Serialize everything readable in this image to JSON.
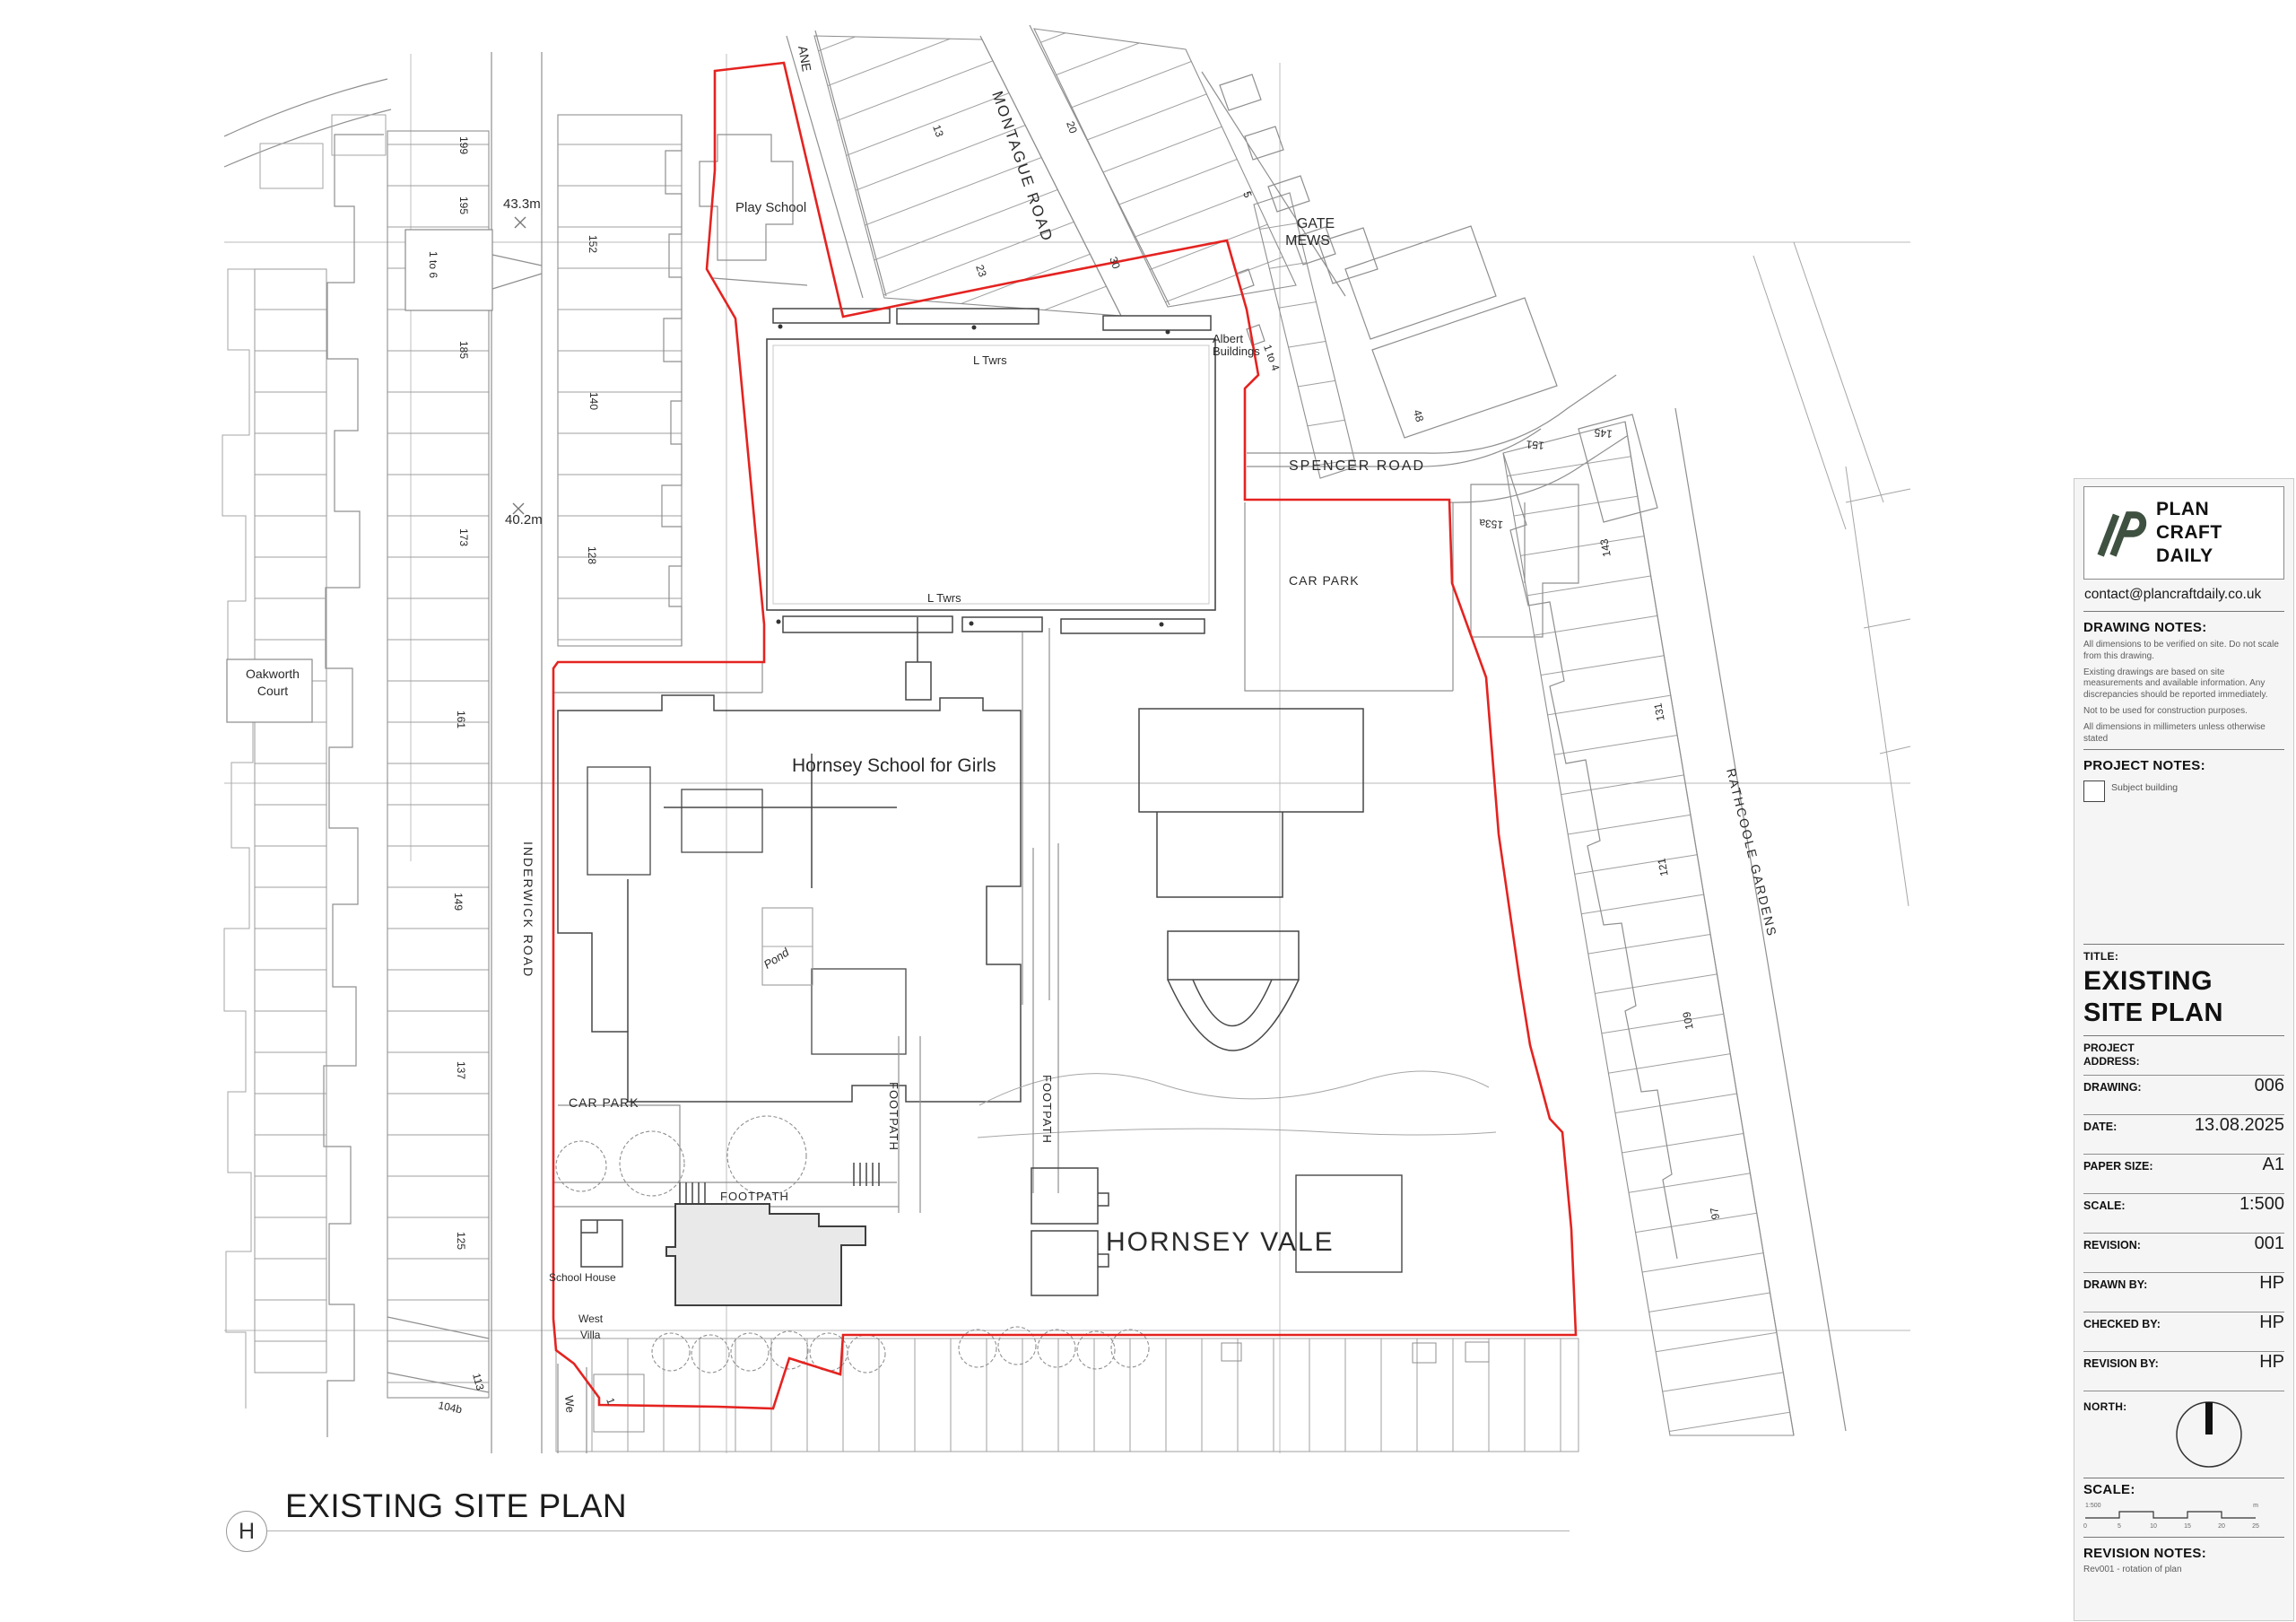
{
  "colors": {
    "boundary_red": "#e42320",
    "line_grey": "#8f8f8f",
    "site_line": "#474747",
    "subject_fill": "#e9e9e9",
    "panel_bg": "#f5f5f5",
    "logo_green": "#3f5140"
  },
  "sheet": {
    "plan_label": "EXISTING SITE PLAN",
    "detail_marker": "H"
  },
  "map": {
    "labels": [
      {
        "id": "play-school",
        "text": "Play School"
      },
      {
        "id": "lane-partial",
        "text": "ANE"
      },
      {
        "id": "montague-road",
        "text": "MONTAGUE ROAD"
      },
      {
        "id": "gate-mews-1",
        "text": "GATE"
      },
      {
        "id": "gate-mews-2",
        "text": "MEWS"
      },
      {
        "id": "albert-1",
        "text": "Albert"
      },
      {
        "id": "albert-2",
        "text": "Buildings"
      },
      {
        "id": "no-1to4",
        "text": "1 to 4"
      },
      {
        "id": "no-5",
        "text": "5"
      },
      {
        "id": "no-13",
        "text": "13"
      },
      {
        "id": "no-23",
        "text": "23"
      },
      {
        "id": "no-20",
        "text": "20"
      },
      {
        "id": "no-30",
        "text": "30"
      },
      {
        "id": "no-48",
        "text": "48"
      },
      {
        "id": "spencer-road",
        "text": "SPENCER ROAD"
      },
      {
        "id": "car-park-east",
        "text": "CAR PARK"
      },
      {
        "id": "l-twrs-1",
        "text": "L Twrs"
      },
      {
        "id": "l-twrs-2",
        "text": "L Twrs"
      },
      {
        "id": "hornsey-school",
        "text": "Hornsey School for Girls"
      },
      {
        "id": "pond",
        "text": "Pond"
      },
      {
        "id": "oakworth-1",
        "text": "Oakworth"
      },
      {
        "id": "oakworth-2",
        "text": "Court"
      },
      {
        "id": "inderwick-road",
        "text": "INDERWICK ROAD"
      },
      {
        "id": "no-199",
        "text": "199"
      },
      {
        "id": "no-195",
        "text": "195"
      },
      {
        "id": "no-185",
        "text": "185"
      },
      {
        "id": "no-173",
        "text": "173"
      },
      {
        "id": "no-161",
        "text": "161"
      },
      {
        "id": "no-149",
        "text": "149"
      },
      {
        "id": "no-137",
        "text": "137"
      },
      {
        "id": "no-125",
        "text": "125"
      },
      {
        "id": "no-113",
        "text": "113"
      },
      {
        "id": "no-104b",
        "text": "104b"
      },
      {
        "id": "no-152",
        "text": "152"
      },
      {
        "id": "no-140",
        "text": "140"
      },
      {
        "id": "no-128",
        "text": "128"
      },
      {
        "id": "no-1to6",
        "text": "1 to 6"
      },
      {
        "id": "level-43",
        "text": "43.3m"
      },
      {
        "id": "level-40",
        "text": "40.2m"
      },
      {
        "id": "rathcoole-gardens",
        "text": "RATHCOOLE GARDENS"
      },
      {
        "id": "no-151",
        "text": "151"
      },
      {
        "id": "no-145",
        "text": "145"
      },
      {
        "id": "no-153a",
        "text": "153a"
      },
      {
        "id": "no-143",
        "text": "143"
      },
      {
        "id": "no-131",
        "text": "131"
      },
      {
        "id": "no-121",
        "text": "121"
      },
      {
        "id": "no-109",
        "text": "109"
      },
      {
        "id": "no-97",
        "text": "97"
      },
      {
        "id": "car-park-west",
        "text": "CAR PARK"
      },
      {
        "id": "footpath-h",
        "text": "FOOTPATH"
      },
      {
        "id": "footpath-v1",
        "text": "FOOTPATH"
      },
      {
        "id": "footpath-v2",
        "text": "FOOTPATH"
      },
      {
        "id": "school-house",
        "text": "School House"
      },
      {
        "id": "west-villa-1",
        "text": "West"
      },
      {
        "id": "west-villa-2",
        "text": "Villa"
      },
      {
        "id": "hornsey-vale",
        "text": "HORNSEY VALE"
      },
      {
        "id": "we-partial",
        "text": "We"
      },
      {
        "id": "no-1-bottom",
        "text": "1"
      }
    ]
  },
  "title_block": {
    "logo": {
      "line1": "PLAN",
      "line2": "CRAFT",
      "line3": "DAILY",
      "contact": "contact@plancraftdaily.co.uk"
    },
    "drawing_notes": {
      "heading": "DRAWING NOTES:",
      "notes": [
        "All dimensions to be verified on site. Do not scale from this drawing.",
        "Existing drawings are based on site measurements and available information. Any discrepancies should be reported immediately.",
        "Not to be used for construction purposes.",
        "All dimensions in millimeters unless otherwise stated"
      ]
    },
    "project_notes": {
      "heading": "PROJECT NOTES:",
      "legend_label": "Subject building"
    },
    "title_section": {
      "label": "TITLE:",
      "line1": "EXISTING",
      "line2": "SITE PLAN"
    },
    "project_address": {
      "label": "PROJECT ADDRESS:",
      "value": ""
    },
    "fields": [
      {
        "label": "DRAWING:",
        "value": "006"
      },
      {
        "label": "DATE:",
        "value": "13.08.2025"
      },
      {
        "label": "PAPER SIZE:",
        "value": "A1"
      },
      {
        "label": "SCALE:",
        "value": "1:500"
      },
      {
        "label": "REVISION:",
        "value": "001"
      },
      {
        "label": "DRAWN BY:",
        "value": "HP"
      },
      {
        "label": "CHECKED BY:",
        "value": "HP"
      },
      {
        "label": "REVISION BY:",
        "value": "HP"
      }
    ],
    "north": {
      "label": "NORTH:"
    },
    "scale_section": {
      "label": "SCALE:",
      "ratio": "1:500",
      "ticks": [
        "0",
        "5",
        "10",
        "15",
        "20",
        "25"
      ],
      "unit": "m"
    },
    "revision_notes": {
      "heading": "REVISION NOTES:",
      "notes": [
        "Rev001 - rotation of plan"
      ]
    }
  }
}
